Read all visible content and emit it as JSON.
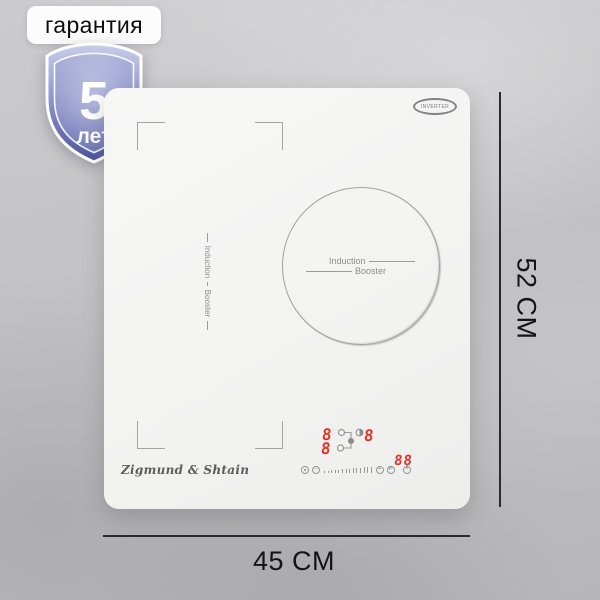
{
  "warranty_badge": {
    "label": "гарантия",
    "years": "5",
    "unit": "лет"
  },
  "dimensions": {
    "height_label": "52 CM",
    "width_label": "45 CM"
  },
  "cooktop": {
    "brand": "Zigmund & Shtain",
    "inverter_label": "INVERTER",
    "left_zone": {
      "line1": "Induction",
      "line2": "Booster"
    },
    "center_zone": {
      "line1": "Induction",
      "line2": "Booster"
    },
    "display": {
      "zone_left_top": "8",
      "zone_right": "8",
      "zone_left_bottom": "8",
      "timer": "88"
    },
    "control_icons": {
      "names": [
        "timer-icon",
        "minus-icon",
        "power-slider-ticks",
        "plus-icon",
        "booster-p-icon",
        "power-icon"
      ],
      "minus_glyph": "−",
      "plus_glyph": "+",
      "boost_glyph": "P"
    }
  },
  "colors": {
    "background_gray": "#c7c7c9",
    "cooktop_white": "#f4f4f3",
    "digit_red": "#e0352b",
    "dimension_line": "#2a2a2c",
    "shield_top": "#c7cbe9",
    "shield_bottom": "#51579c"
  }
}
